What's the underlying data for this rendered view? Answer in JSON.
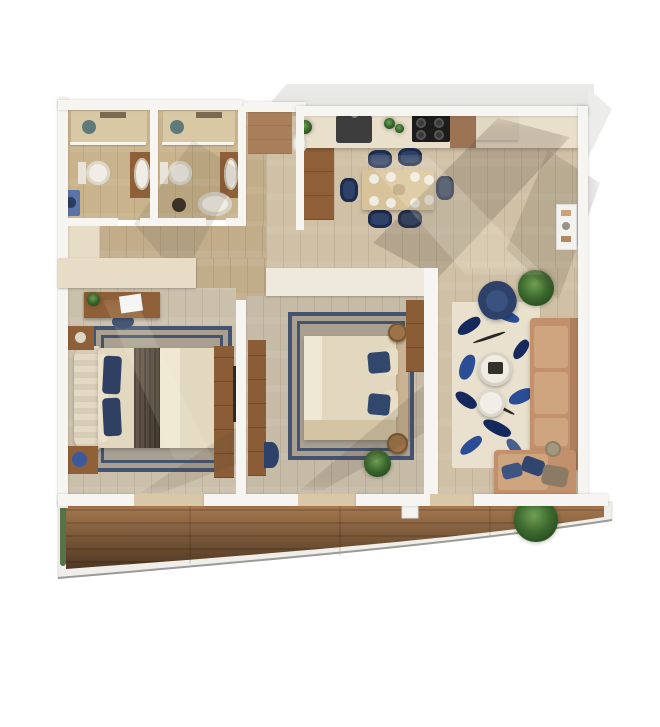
{
  "title": "apartment-3d-floor-plan-top-view",
  "palette": {
    "bg": "#ffffff",
    "wall": "#f6f5f1",
    "wall_shade": "#e3e3e1",
    "wall_beige": "#e7dcc6",
    "floor_main": "#cfc0a6",
    "floor_bath": "#c9b38c",
    "floor_bed1": "#cbc0ab",
    "floor_bed2": "#c6bba7",
    "floor_corridor": "#c2ad8b",
    "entry_mat": "#a87f5a",
    "balcony_light": "#a87a50",
    "balcony_dark": "#4e3722",
    "navy": "#2e4168",
    "navy_dark": "#1d2c4d",
    "rug_border": "#46536f",
    "rug_bed": "#a9a092",
    "rug_living": "#e9e1ce",
    "rug_blue": "#2a4d96",
    "rug_blue_dark": "#16295c",
    "sofa": "#c2916b",
    "sofa_cushion": "#cfa57f",
    "wood": "#8f6038",
    "wood_light": "#d8c299",
    "counter": "#e9dfcb",
    "cabinet": "#9b7355",
    "black": "#1c1c1c",
    "white_fix": "#f0ede6",
    "green": "#3c6b2f",
    "green_dark": "#1f3d18",
    "shadow_c": "rgba(84,70,56,0.22)",
    "threshold": "#d9c8a8",
    "linen": "#e2d8bf",
    "headboard": "#e4d9c2",
    "throw": "#584a3c",
    "washer": "#5b74a8",
    "drain": "#4a6b74"
  },
  "plan": {
    "view": "top-down 3d render, no text labels",
    "rooms": [
      {
        "id": "bathroom-1",
        "furniture": [
          "shower-tray",
          "drain",
          "toilet",
          "vanity-sink",
          "washer"
        ]
      },
      {
        "id": "bathroom-2",
        "furniture": [
          "shower-tray",
          "drain",
          "toilet",
          "vanity-sink",
          "bathtub",
          "stool"
        ]
      },
      {
        "id": "entry-hall",
        "furniture": [
          "doormat",
          "hall-closet",
          "vase-plant"
        ]
      },
      {
        "id": "kitchen",
        "furniture": [
          "counter",
          "sink",
          "cooktop",
          "cabinet",
          "tall-unit",
          "herb-pots",
          "floor-vase"
        ]
      },
      {
        "id": "dining-area",
        "furniture": [
          "dining-table",
          "dining-chairs",
          "plates",
          "centerpiece"
        ]
      },
      {
        "id": "living-room",
        "furniture": [
          "abstract-rug",
          "coffee-table-large",
          "coffee-table-small",
          "armchair",
          "corner-sofa",
          "chaise-pillows",
          "side-stool",
          "plant",
          "wall-niche-shelf"
        ]
      },
      {
        "id": "bedroom-1",
        "furniture": [
          "double-bed",
          "bordered-rug",
          "desk",
          "desk-stool",
          "nightstand-top",
          "nightstand-bottom",
          "tv-console",
          "corridor-cabinet"
        ]
      },
      {
        "id": "bedroom-2",
        "furniture": [
          "double-bed",
          "bordered-rug",
          "dresser",
          "pouf",
          "round-nightstand-top",
          "round-nightstand-bottom",
          "built-in-wardrobe",
          "plant"
        ]
      },
      {
        "id": "balcony",
        "furniture": [
          "wood-deck",
          "railing",
          "pillar",
          "planter-strip",
          "plant"
        ]
      }
    ],
    "counts": {
      "bedrooms": 2,
      "bathrooms": 2,
      "dining_chairs": 6,
      "coffee_tables": 2,
      "plants": 5
    }
  }
}
